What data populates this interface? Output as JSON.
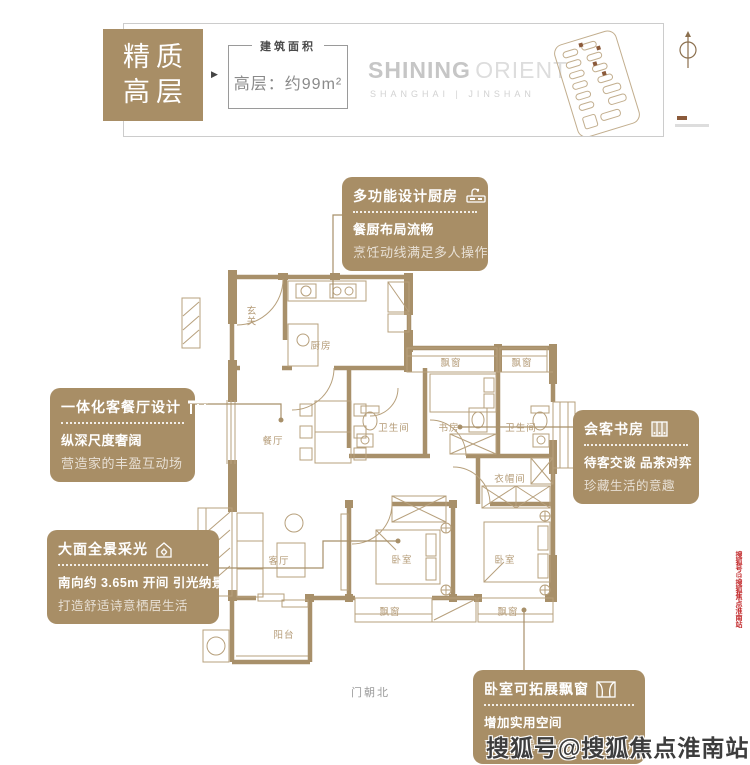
{
  "header": {
    "badge_line1": "精质",
    "badge_line2": "高层",
    "arrow": "▶",
    "area_label": "建筑面积",
    "area_value": "高层：约99m²",
    "logo_main": "SHINING",
    "logo_sub": "ORIENT",
    "logo_tagline": "SHANGHAI | JINSHAN"
  },
  "callouts": {
    "kitchen": {
      "title": "多功能设计厨房",
      "line1": "餐厨布局流畅",
      "line2": "烹饪动线满足多人操作"
    },
    "dining": {
      "title": "一体化客餐厅设计",
      "line1": "纵深尺度奢阔",
      "line2": "营造家的丰盈互动场"
    },
    "daylight": {
      "title": "大面全景采光",
      "line1": "南向约 3.65m 开间 引光纳景",
      "line2": "打造舒适诗意栖居生活"
    },
    "study": {
      "title": "会客书房",
      "line1": "待客交谈 品茶对弈",
      "line2": "珍藏生活的意趣"
    },
    "baywindow": {
      "title": "卧室可拓展飘窗",
      "line1": "增加实用空间",
      "line2": "可改造榻榻米或小型阅读角"
    }
  },
  "floorplan": {
    "labels": {
      "entry": "玄关",
      "kitchen": "厨房",
      "dining": "餐厅",
      "living": "客厅",
      "balcony": "阳台",
      "bedroom": "卧室",
      "study": "书房",
      "bath": "卫生间",
      "cloak": "衣帽间",
      "bay": "飘窗"
    },
    "door_note": "门朝北"
  },
  "watermarks": {
    "bottom": "搜狐号@搜狐焦点淮南站",
    "side": "搜狐号@搜狐焦点淮南站"
  },
  "colors": {
    "gold": "#a88e66",
    "plan_wall": "#a8906a",
    "plan_line": "#b7a07c",
    "watermark_red": "#c2292b",
    "logo_gray": "#c6c6c6"
  }
}
